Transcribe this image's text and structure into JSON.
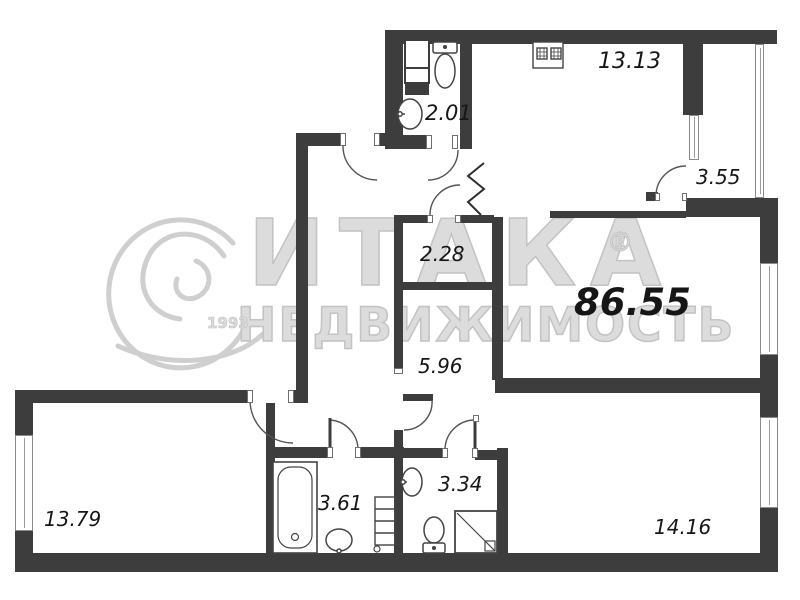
{
  "watermark": {
    "brand": "ИТАКА",
    "registered": "®",
    "subtitle": "НЕДВИЖИМОСТЬ",
    "year": "1993"
  },
  "plan": {
    "type": "apartment-floor-plan",
    "total_area": "86.55",
    "rooms": [
      {
        "id": "kitchen-living",
        "area": "13.13"
      },
      {
        "id": "bathroom-top",
        "area": "2.01"
      },
      {
        "id": "hallway-balcony",
        "area": "3.55"
      },
      {
        "id": "storage",
        "area": "2.28"
      },
      {
        "id": "corridor",
        "area": "5.96"
      },
      {
        "id": "room-left",
        "area": "13.79"
      },
      {
        "id": "bathroom-bottom",
        "area": "3.61"
      },
      {
        "id": "wc",
        "area": "3.34"
      },
      {
        "id": "room-right",
        "area": "14.16"
      }
    ],
    "colors": {
      "wall": "#3d3d3d",
      "label": "#161616",
      "watermark": "#d9d9d9"
    }
  }
}
